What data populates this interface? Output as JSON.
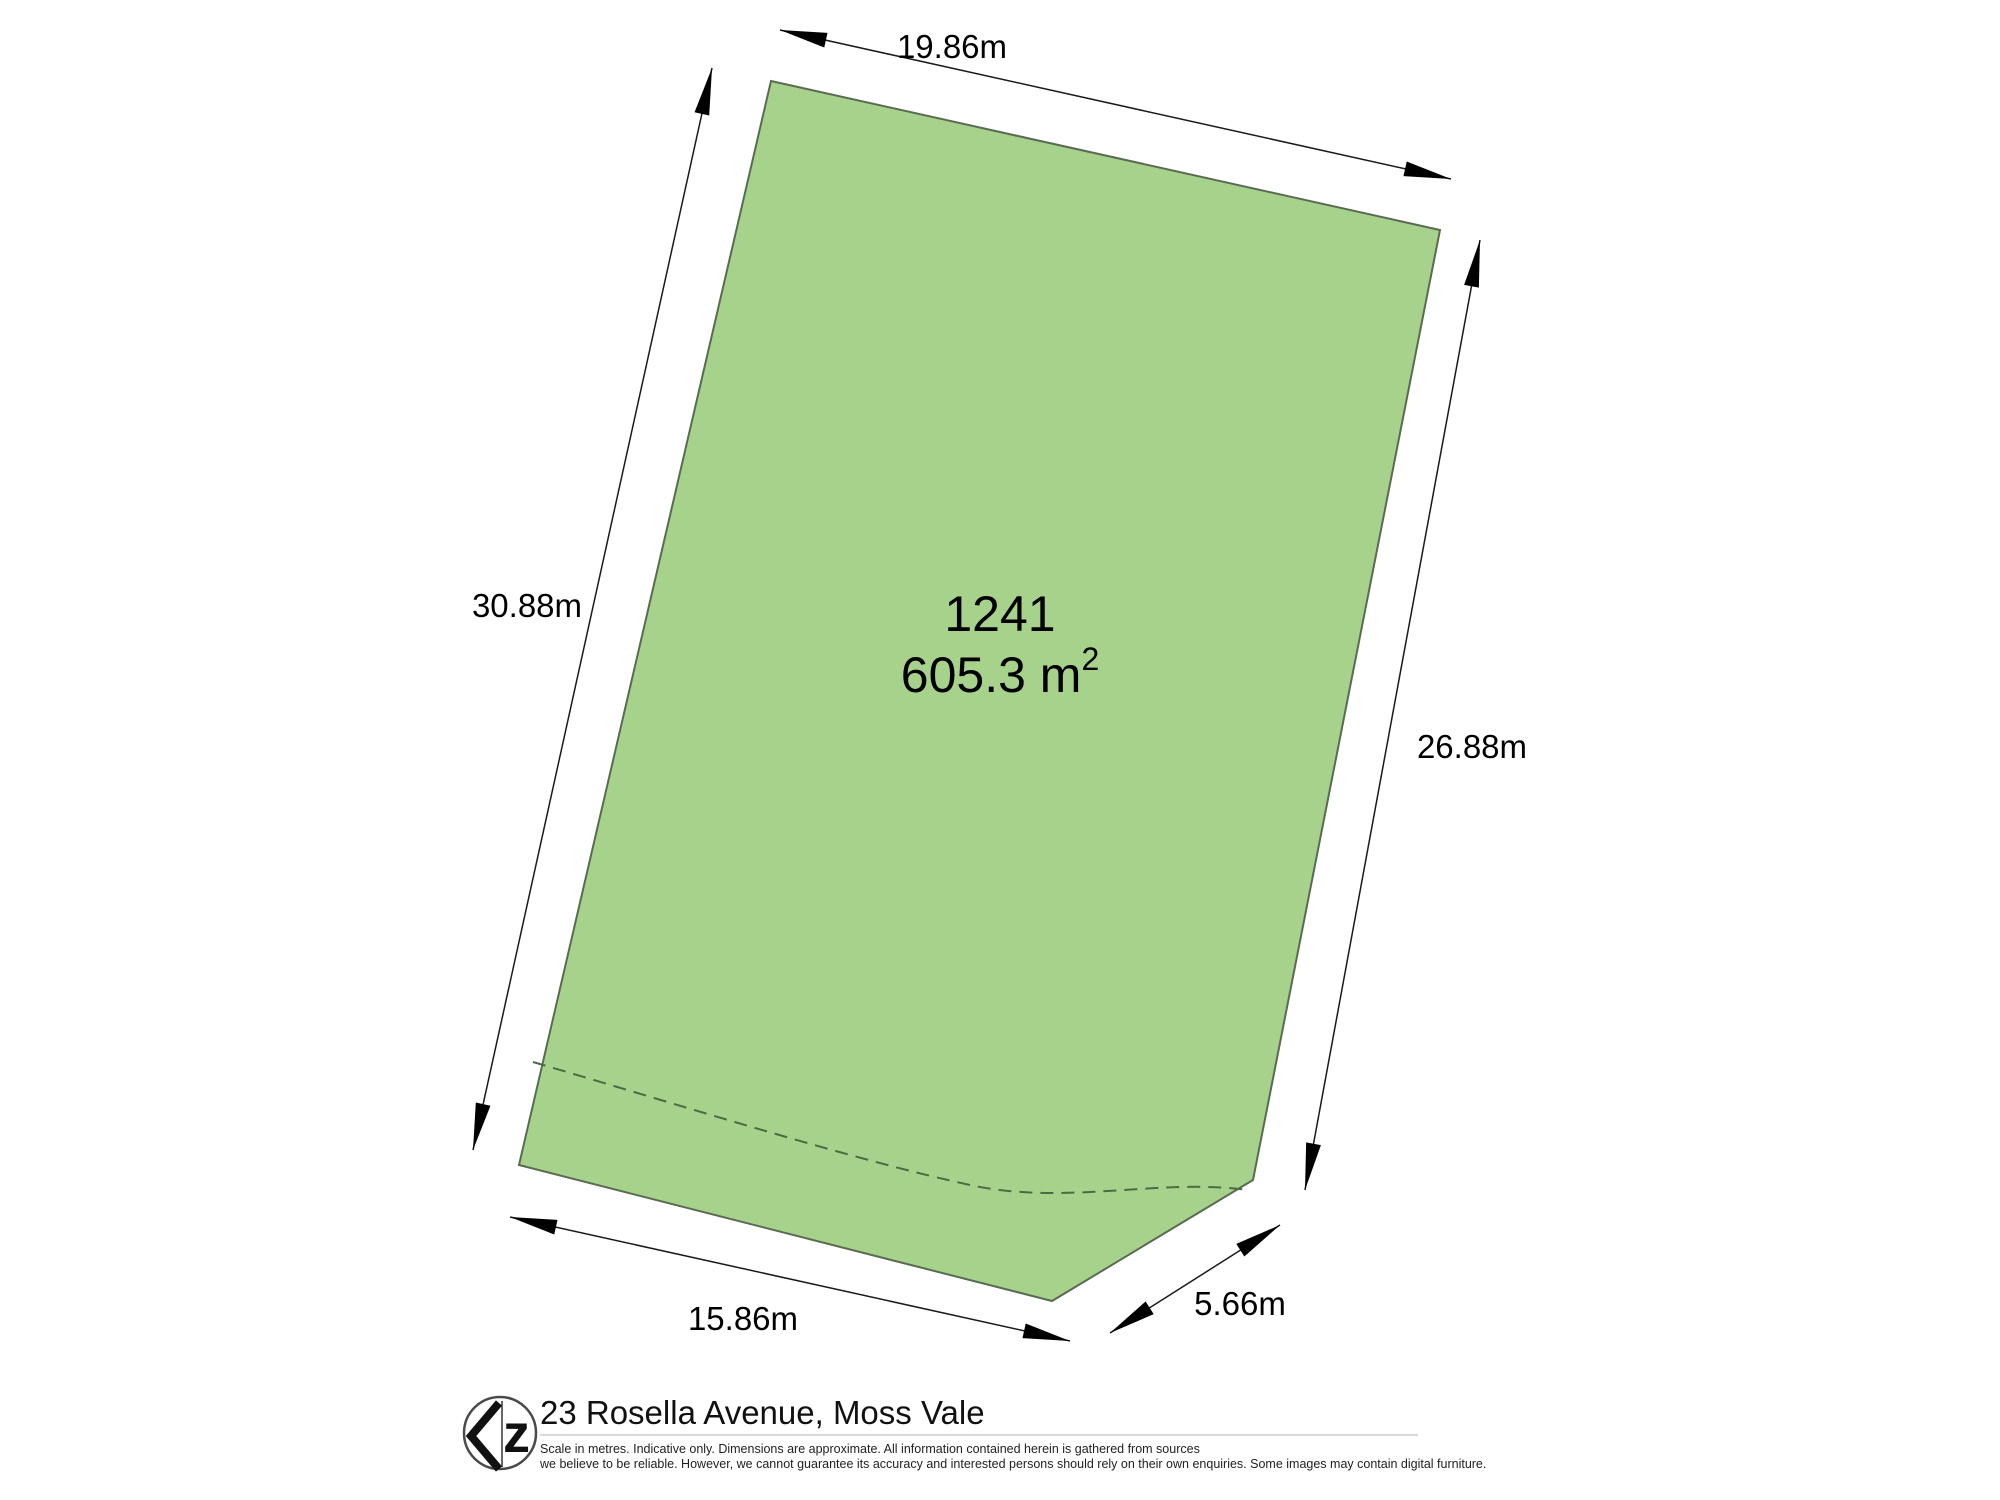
{
  "page": {
    "background": "#ffffff"
  },
  "plan": {
    "lot_number": "1241",
    "area_value": "605.3 m",
    "area_exponent": "2",
    "fill_color": "#a6d28c",
    "outline_color": "#5a6b52",
    "dashed_line_color": "#4c6b42",
    "dimension_color": "#1a1a1a",
    "dimensions": {
      "top": "19.86m",
      "left": "30.88m",
      "right": "26.88m",
      "bottom": "15.86m",
      "corner": "5.66m"
    }
  },
  "footer": {
    "logo_letter": "z",
    "address": "23 Rosella Avenue, Moss Vale",
    "disclaimer_line1": "Scale in metres. Indicative only. Dimensions are approximate. All information contained herein is gathered from sources",
    "disclaimer_line2": "we believe to be reliable. However, we cannot guarantee its accuracy and interested persons should rely on their own enquiries. Some images may contain digital furniture."
  }
}
